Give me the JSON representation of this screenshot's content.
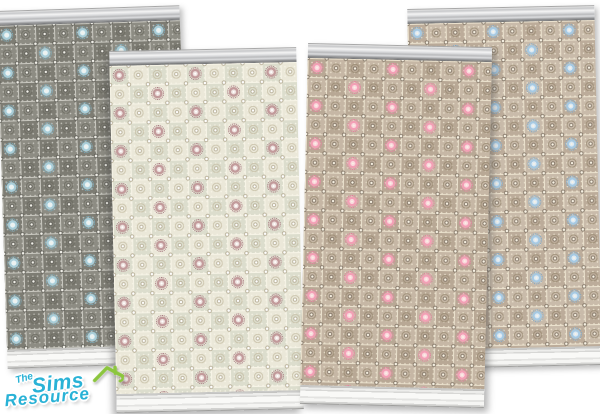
{
  "image": {
    "description": "Preview of four Sims wallpaper swatches with ornate tiled lace pattern, crown molding and baseboard",
    "background": "#ffffff"
  },
  "logo": {
    "the": "The",
    "sims": "Sims",
    "resource": "Resource",
    "text_color": "#29b2d6",
    "outline_color": "#ffffff",
    "roof_color": "#8cc63e"
  },
  "panels": [
    {
      "name": "gray-wallpaper-blue-accent",
      "colors": {
        "base": "#8d8c83",
        "tile_alt": "#7d7c73",
        "grout": "#c9c8c0",
        "dot_light": "#f2f1ea",
        "dot_dark": "#4e4d46",
        "motif": "#6a695f",
        "accent": "#a8cdd8",
        "accent_dark": "#74aabd",
        "accent_core": "#e8f2f4"
      }
    },
    {
      "name": "cream-wallpaper-mauve-accent",
      "colors": {
        "base": "#ebe8d9",
        "tile_alt": "#dcddcd",
        "grout": "#f7f4e7",
        "dot_light": "#ffffff",
        "dot_dark": "#a99f84",
        "motif": "#c3bba1",
        "accent": "#c29a9b",
        "accent_dark": "#a87e84",
        "accent_core": "#efe3e0"
      }
    },
    {
      "name": "tan-wallpaper-pink-accent",
      "colors": {
        "base": "#c6b7a5",
        "tile_alt": "#b8a895",
        "grout": "#eae1cd",
        "dot_light": "#f8f2e4",
        "dot_dark": "#6f6253",
        "motif": "#96876f",
        "accent": "#f2a0b5",
        "accent_dark": "#e27d9b",
        "accent_core": "#fbd7dd"
      }
    },
    {
      "name": "tan-wallpaper-blue-accent",
      "colors": {
        "base": "#c9bbaa",
        "tile_alt": "#bcac9a",
        "grout": "#ece3cf",
        "dot_light": "#f8f2e4",
        "dot_dark": "#6f6253",
        "motif": "#96876f",
        "accent": "#a6c9e2",
        "accent_dark": "#7ea8cb",
        "accent_core": "#ddeaf4"
      }
    }
  ]
}
